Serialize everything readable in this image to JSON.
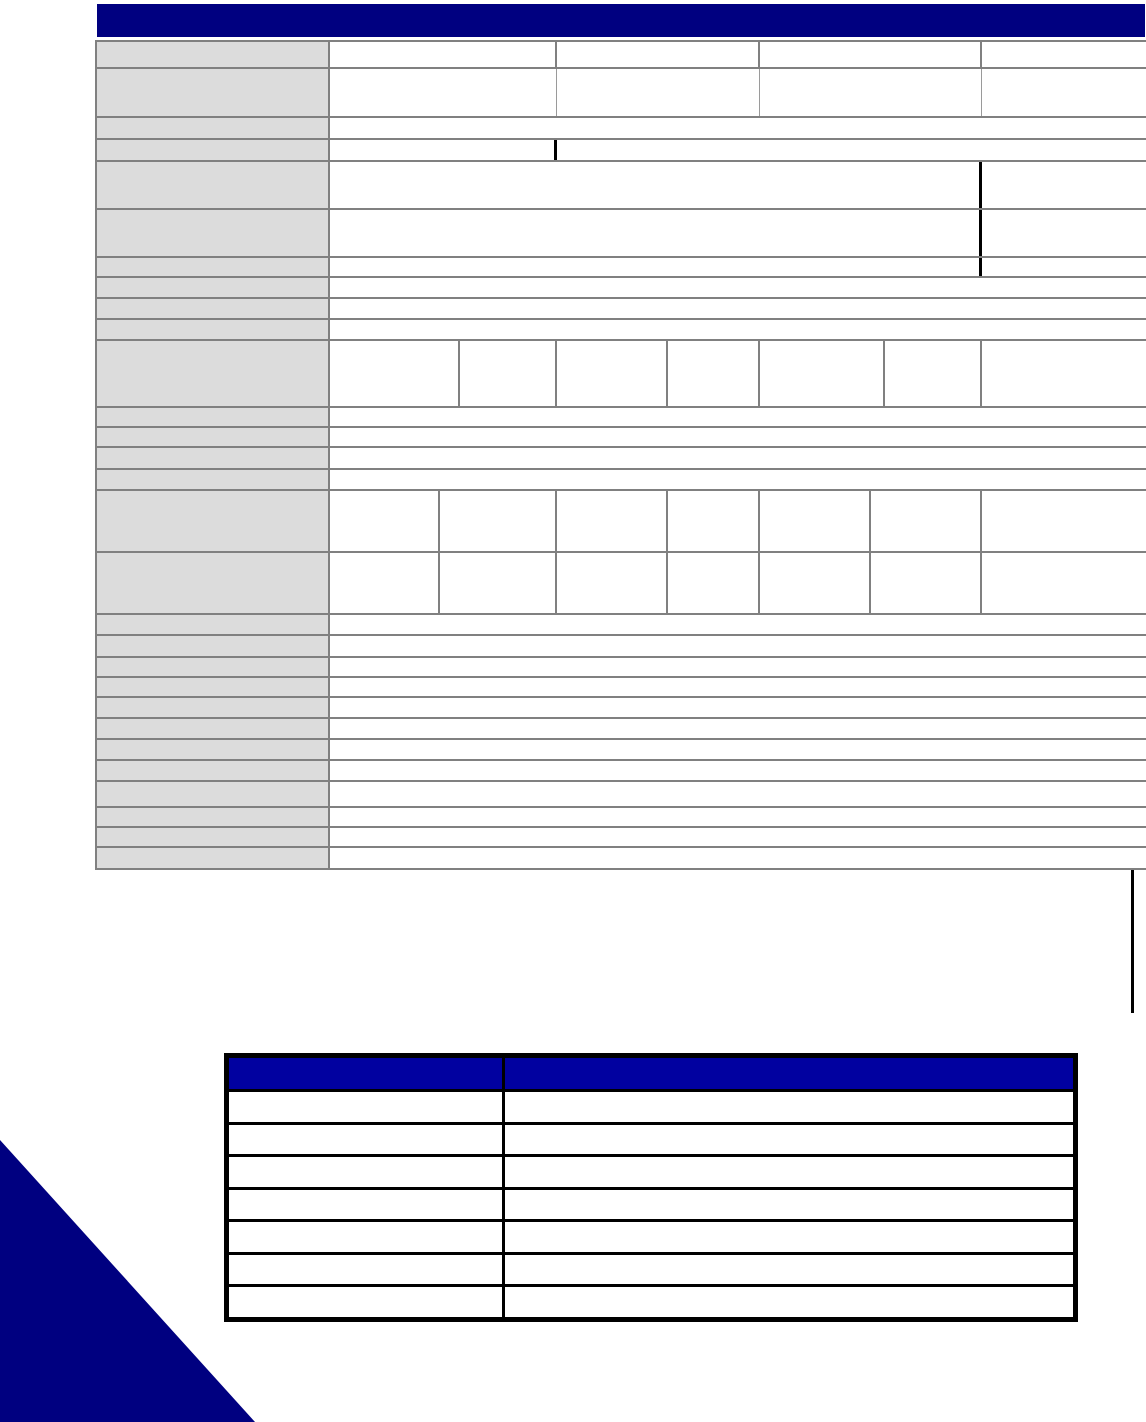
{
  "document": {
    "kind": "blank specification sheet page",
    "visible_text": "",
    "page_background": "#ffffff"
  },
  "colors": {
    "title_bar_navy": "#000080",
    "grid_border_gray": "#808080",
    "light_divider_gray": "#9a9a9a",
    "label_cell_gray": "#dcdcdc",
    "cell_white": "#ffffff",
    "black": "#000000",
    "notes_header_navy": "#0101a0",
    "corner_triangle_navy": "#000080"
  },
  "header_bar": {
    "x": 97,
    "y": 4,
    "width": 1048,
    "height": 33
  },
  "main_table": {
    "x": 95,
    "y": 40,
    "width": 1051,
    "label_col_width": 233,
    "rows": [
      {
        "height": 27,
        "cells": [
          {
            "w": 233,
            "t": "label"
          },
          {
            "w": 227,
            "d": "gray"
          },
          {
            "w": 203,
            "d": "gray"
          },
          {
            "w": 222,
            "d": "gray"
          },
          {
            "flex": true
          }
        ]
      },
      {
        "height": 49,
        "cells": [
          {
            "w": 233,
            "t": "label"
          },
          {
            "w": 227,
            "d": "light"
          },
          {
            "w": 203,
            "d": "light"
          },
          {
            "w": 222,
            "d": "light"
          },
          {
            "flex": true
          }
        ]
      },
      {
        "height": 22,
        "cells": [
          {
            "w": 233,
            "t": "label"
          },
          {
            "flex": true
          }
        ]
      },
      {
        "height": 22,
        "cells": [
          {
            "w": 233,
            "t": "label"
          },
          {
            "w": 227,
            "d": "black"
          },
          {
            "flex": true
          }
        ]
      },
      {
        "height": 48,
        "cells": [
          {
            "w": 233,
            "t": "label"
          },
          {
            "w": 652,
            "d": "black"
          },
          {
            "flex": true
          }
        ]
      },
      {
        "height": 48,
        "cells": [
          {
            "w": 233,
            "t": "label"
          },
          {
            "w": 652,
            "d": "black"
          },
          {
            "flex": true
          }
        ]
      },
      {
        "height": 20,
        "cells": [
          {
            "w": 233,
            "t": "label"
          },
          {
            "w": 652,
            "d": "black"
          },
          {
            "flex": true
          }
        ]
      },
      {
        "height": 21,
        "cells": [
          {
            "w": 233,
            "t": "label"
          },
          {
            "flex": true
          }
        ]
      },
      {
        "height": 21,
        "cells": [
          {
            "w": 233,
            "t": "label"
          },
          {
            "flex": true
          }
        ]
      },
      {
        "height": 21,
        "cells": [
          {
            "w": 233,
            "t": "label"
          },
          {
            "flex": true
          }
        ]
      },
      {
        "height": 67,
        "cells": [
          {
            "w": 233,
            "t": "label"
          },
          {
            "w": 130,
            "d": "gray"
          },
          {
            "w": 97,
            "d": "gray"
          },
          {
            "w": 111,
            "d": "gray"
          },
          {
            "w": 92,
            "d": "gray"
          },
          {
            "w": 125,
            "d": "gray"
          },
          {
            "w": 97,
            "d": "gray"
          },
          {
            "flex": true
          }
        ]
      },
      {
        "height": 20,
        "cells": [
          {
            "w": 233,
            "t": "label"
          },
          {
            "flex": true
          }
        ]
      },
      {
        "height": 20,
        "cells": [
          {
            "w": 233,
            "t": "label"
          },
          {
            "flex": true
          }
        ]
      },
      {
        "height": 22,
        "cells": [
          {
            "w": 233,
            "t": "label"
          },
          {
            "flex": true
          }
        ]
      },
      {
        "height": 21,
        "cells": [
          {
            "w": 233,
            "t": "label"
          },
          {
            "flex": true
          }
        ]
      },
      {
        "height": 62,
        "cells": [
          {
            "w": 233,
            "t": "label"
          },
          {
            "w": 110,
            "d": "gray"
          },
          {
            "w": 117,
            "d": "gray"
          },
          {
            "w": 111,
            "d": "gray"
          },
          {
            "w": 92,
            "d": "gray"
          },
          {
            "w": 111,
            "d": "gray"
          },
          {
            "w": 111,
            "d": "gray"
          },
          {
            "flex": true
          }
        ]
      },
      {
        "height": 62,
        "cells": [
          {
            "w": 233,
            "t": "label"
          },
          {
            "w": 110,
            "d": "gray"
          },
          {
            "w": 117,
            "d": "gray"
          },
          {
            "w": 111,
            "d": "gray"
          },
          {
            "w": 92,
            "d": "gray"
          },
          {
            "w": 111,
            "d": "gray"
          },
          {
            "w": 111,
            "d": "gray"
          },
          {
            "flex": true
          }
        ]
      },
      {
        "height": 21,
        "cells": [
          {
            "w": 233,
            "t": "label"
          },
          {
            "flex": true
          }
        ]
      },
      {
        "height": 22,
        "cells": [
          {
            "w": 233,
            "t": "label"
          },
          {
            "flex": true
          }
        ]
      },
      {
        "height": 20,
        "cells": [
          {
            "w": 233,
            "t": "label"
          },
          {
            "flex": true
          }
        ]
      },
      {
        "height": 20,
        "cells": [
          {
            "w": 233,
            "t": "label"
          },
          {
            "flex": true
          }
        ]
      },
      {
        "height": 21,
        "cells": [
          {
            "w": 233,
            "t": "label"
          },
          {
            "flex": true
          }
        ]
      },
      {
        "height": 21,
        "cells": [
          {
            "w": 233,
            "t": "label"
          },
          {
            "flex": true
          }
        ]
      },
      {
        "height": 21,
        "cells": [
          {
            "w": 233,
            "t": "label"
          },
          {
            "flex": true
          }
        ]
      },
      {
        "height": 21,
        "cells": [
          {
            "w": 233,
            "t": "label"
          },
          {
            "flex": true
          }
        ]
      },
      {
        "height": 26,
        "cells": [
          {
            "w": 233,
            "t": "label"
          },
          {
            "flex": true
          }
        ]
      },
      {
        "height": 20,
        "cells": [
          {
            "w": 233,
            "t": "label"
          },
          {
            "flex": true
          }
        ]
      },
      {
        "height": 20,
        "cells": [
          {
            "w": 233,
            "t": "label"
          },
          {
            "flex": true
          }
        ]
      },
      {
        "height": 20,
        "cells": [
          {
            "w": 233,
            "t": "label"
          },
          {
            "flex": true
          }
        ]
      }
    ]
  },
  "trailing_line": {
    "x": 1131,
    "y": 870,
    "width": 3,
    "height": 143
  },
  "notes_table": {
    "x": 224,
    "y": 1053,
    "width": 854,
    "height": 269,
    "header_height": 31,
    "col1_width": 276,
    "body_row_count": 7
  },
  "corner_triangle": {
    "x": 0,
    "y": 1140,
    "width": 255,
    "height": 282
  }
}
